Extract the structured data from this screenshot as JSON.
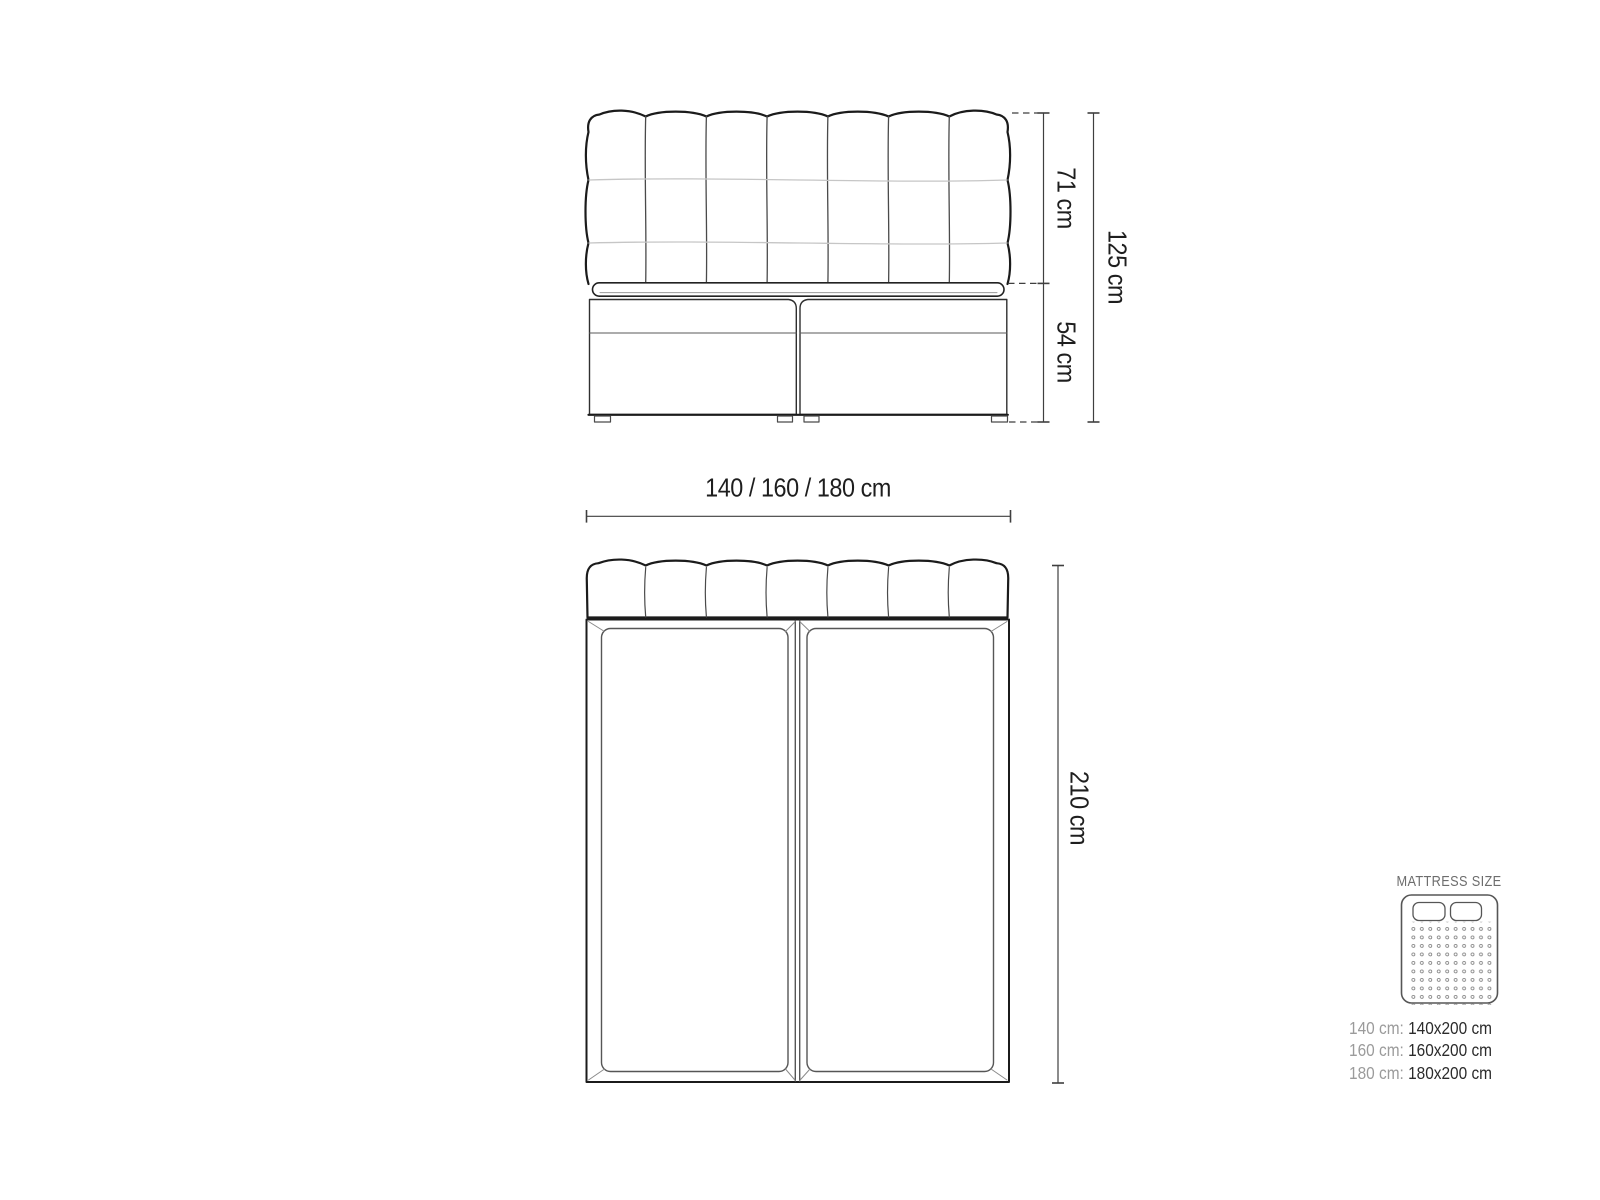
{
  "front_view": {
    "headboard_height": "71 cm",
    "base_height": "54 cm",
    "total_height": "125 cm",
    "width_options": "140 / 160 / 180 cm"
  },
  "top_view": {
    "length": "210 cm"
  },
  "legend": {
    "title": "MATTRESS SIZE",
    "rows": [
      {
        "label": "140 cm:",
        "value": "140x200 cm"
      },
      {
        "label": "160 cm:",
        "value": "160x200 cm"
      },
      {
        "label": "180 cm:",
        "value": "180x200 cm"
      }
    ]
  },
  "colors": {
    "background": "#ffffff",
    "outline_dark": "#1b1b1b",
    "line_medium": "#4a4a4a",
    "line_light": "#c6c6c6",
    "dimension_line": "#3f3f3f",
    "text_primary": "#1e1e1e",
    "text_gray": "#9b9b9b",
    "legend_title": "#6d6d6d"
  }
}
